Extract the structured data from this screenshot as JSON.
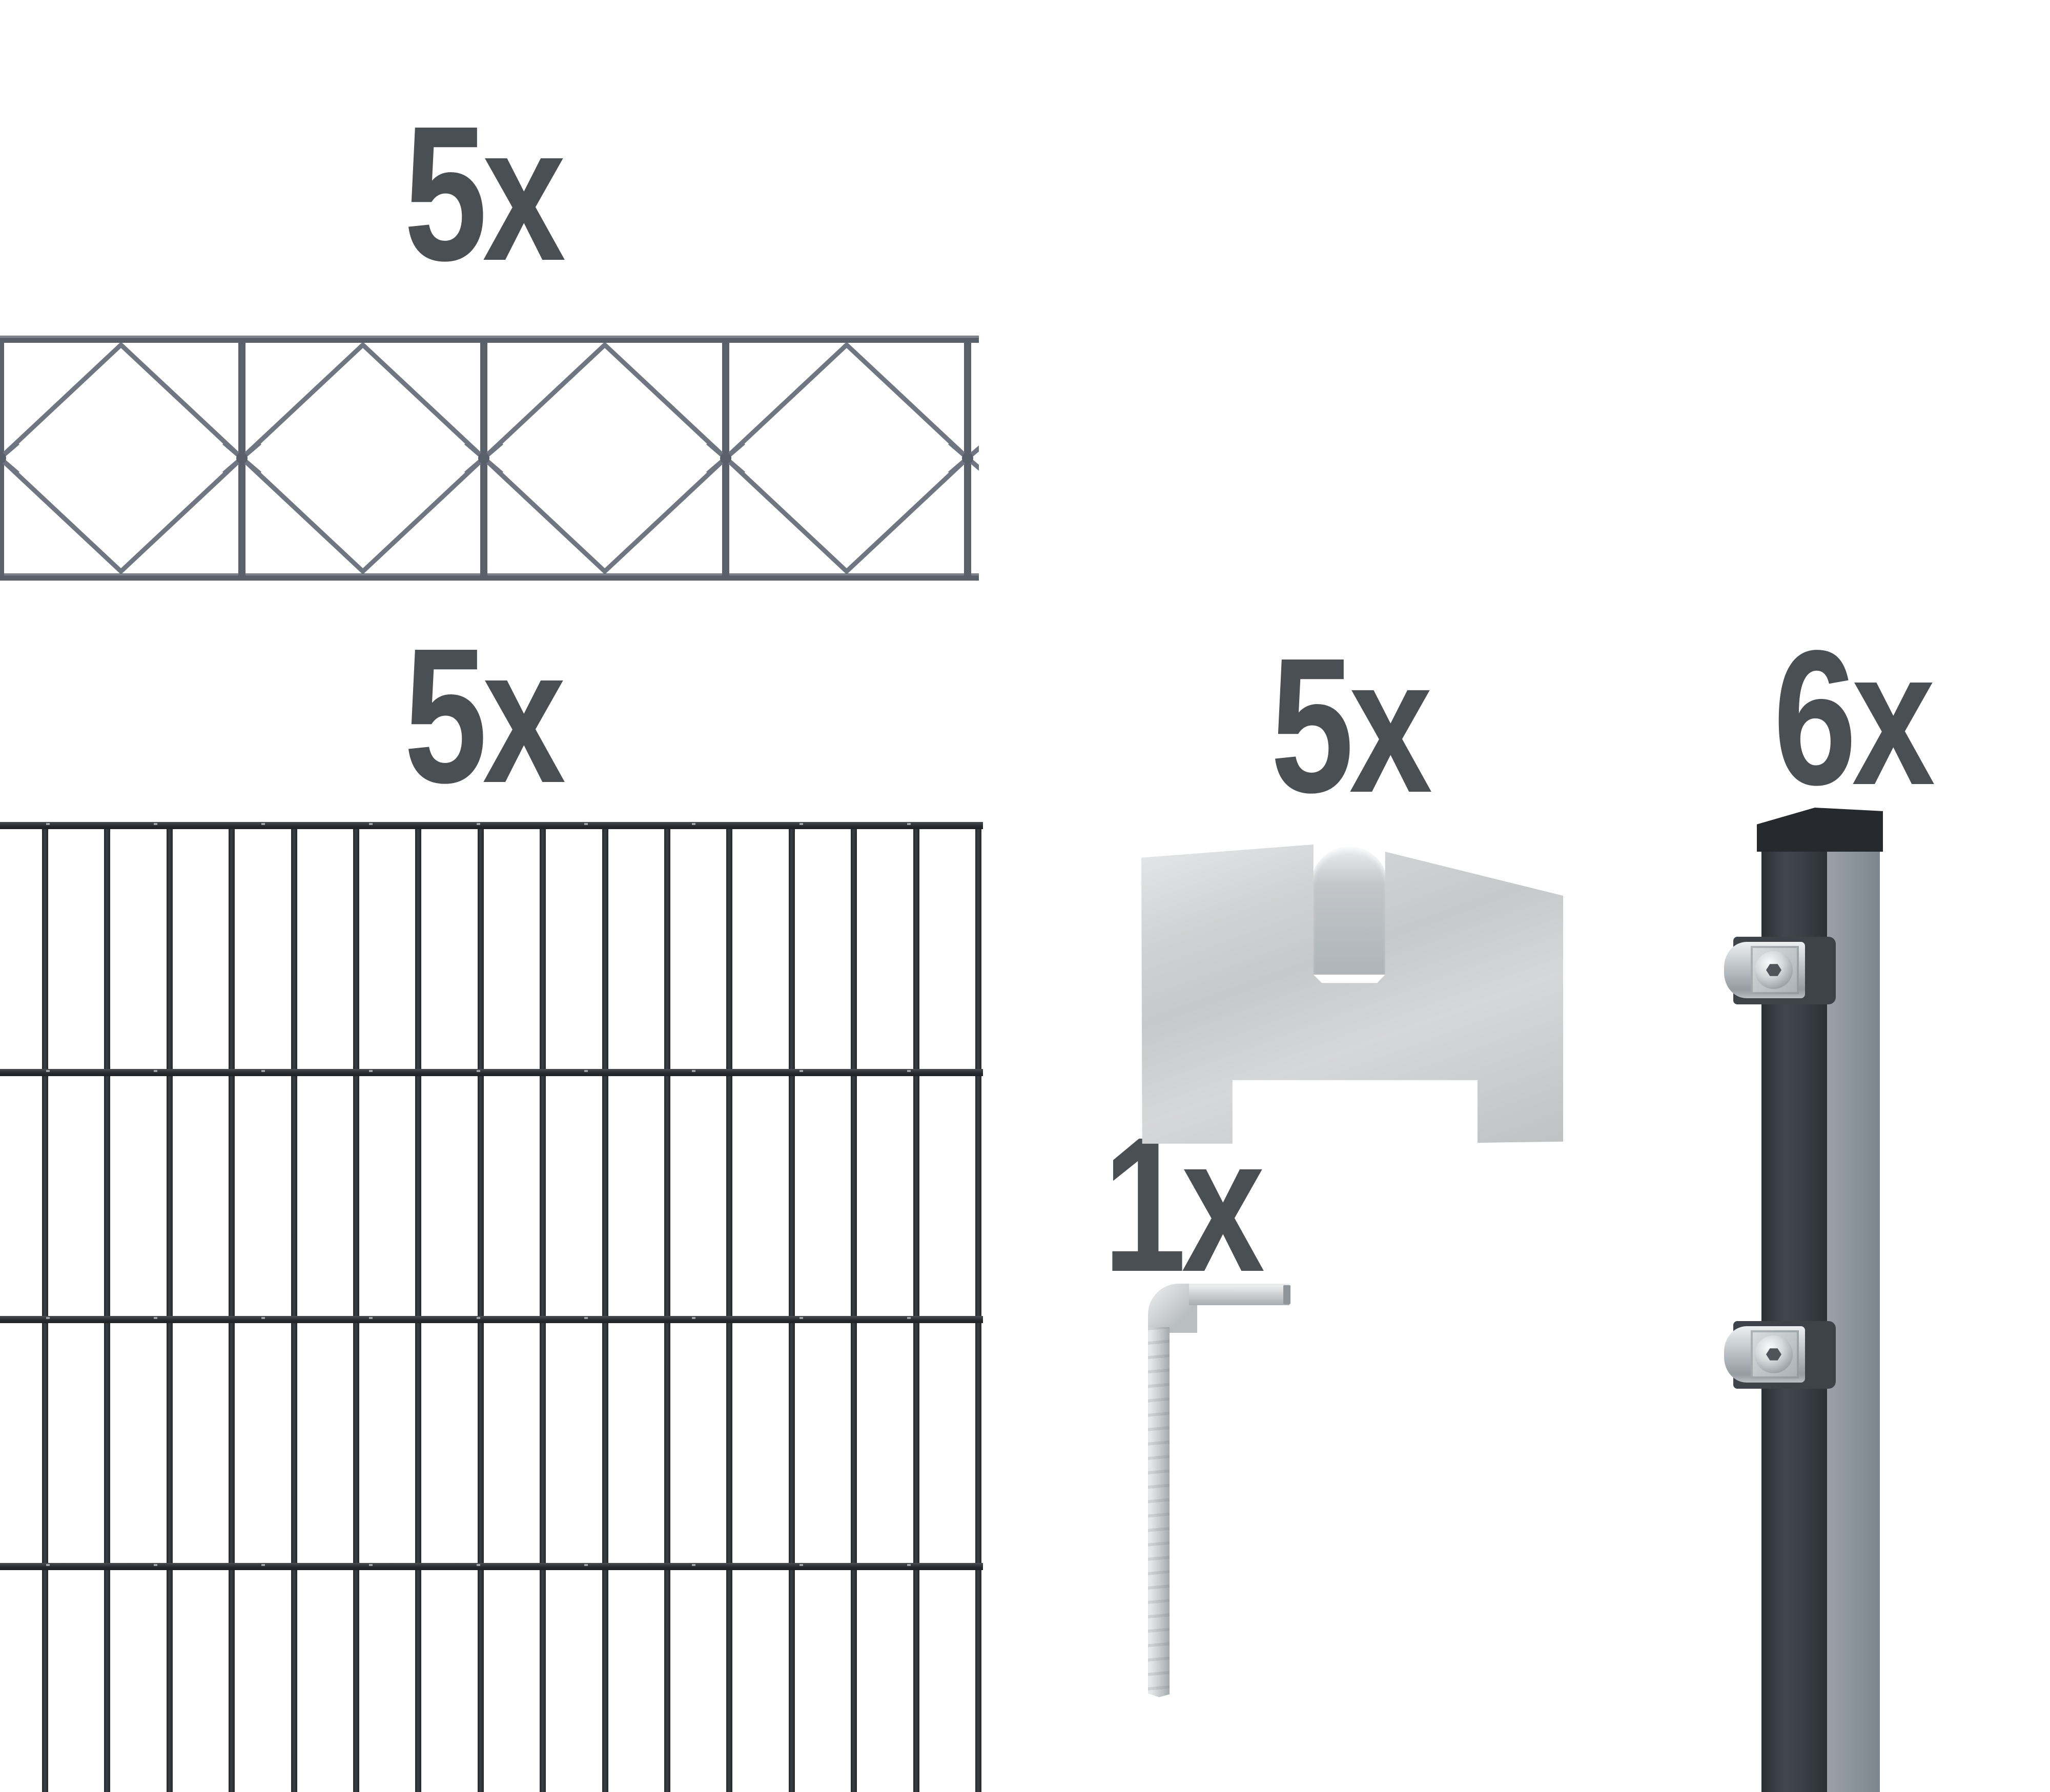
{
  "quantities": {
    "topper": "5x",
    "panel": "5x",
    "clip": "5x",
    "hex_key": "1x",
    "post": "6x"
  },
  "colors": {
    "background": "#ffffff",
    "label_gray": "#4a4f53",
    "panel_anthracite": "#2c3136",
    "topper_gray": "#5a616b",
    "topper_wire_gray": "#6f7681",
    "steel_silver": "#c9cdcf",
    "post_front": "#3a4148",
    "post_side": "#8a929a",
    "post_cap": "#26292d"
  }
}
